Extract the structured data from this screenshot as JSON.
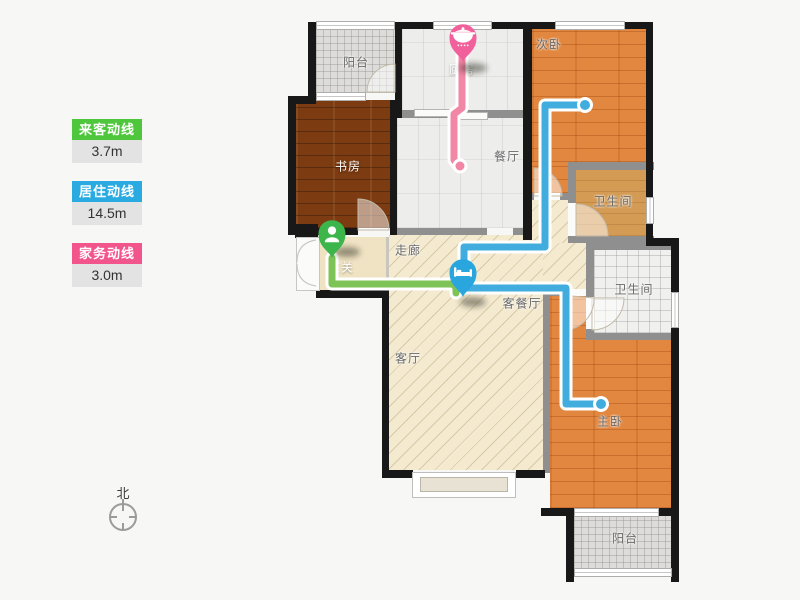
{
  "legend": {
    "items": [
      {
        "id": "visitor-flow",
        "label": "来客动线",
        "value": "3.7m",
        "color": "#4FC73C"
      },
      {
        "id": "living-flow",
        "label": "居住动线",
        "value": "14.5m",
        "color": "#29ABE2"
      },
      {
        "id": "housework-flow",
        "label": "家务动线",
        "value": "3.0m",
        "color": "#F2548C"
      }
    ]
  },
  "compass": {
    "label": "北"
  },
  "floorplan": {
    "rooms": {
      "balcony_top": "阳台",
      "kitchen": "厨房",
      "bedroom2": "次卧",
      "study": "书房",
      "dining": "餐厅",
      "bath1": "卫生间",
      "bath2": "卫生间",
      "hallway": "走廊",
      "entry": "玄关",
      "living_dining": "客餐厅",
      "living": "客厅",
      "master": "主卧",
      "balcony_bottom": "阳台"
    },
    "pins": [
      {
        "id": "kitchen-pin",
        "icon": "pot-icon",
        "room": "厨房",
        "color": "#F2609B"
      },
      {
        "id": "entry-pin",
        "icon": "person-icon",
        "room": "玄关",
        "color": "#3CB54B"
      },
      {
        "id": "bed-pin",
        "icon": "bed-icon",
        "room": "客餐厅",
        "color": "#2AA6DF"
      }
    ],
    "flow_lines": [
      {
        "id": "housework-line",
        "color": "#F287A5"
      },
      {
        "id": "living-line",
        "color": "#41ACDE"
      },
      {
        "id": "visitor-line",
        "color": "#7DC356"
      }
    ]
  }
}
